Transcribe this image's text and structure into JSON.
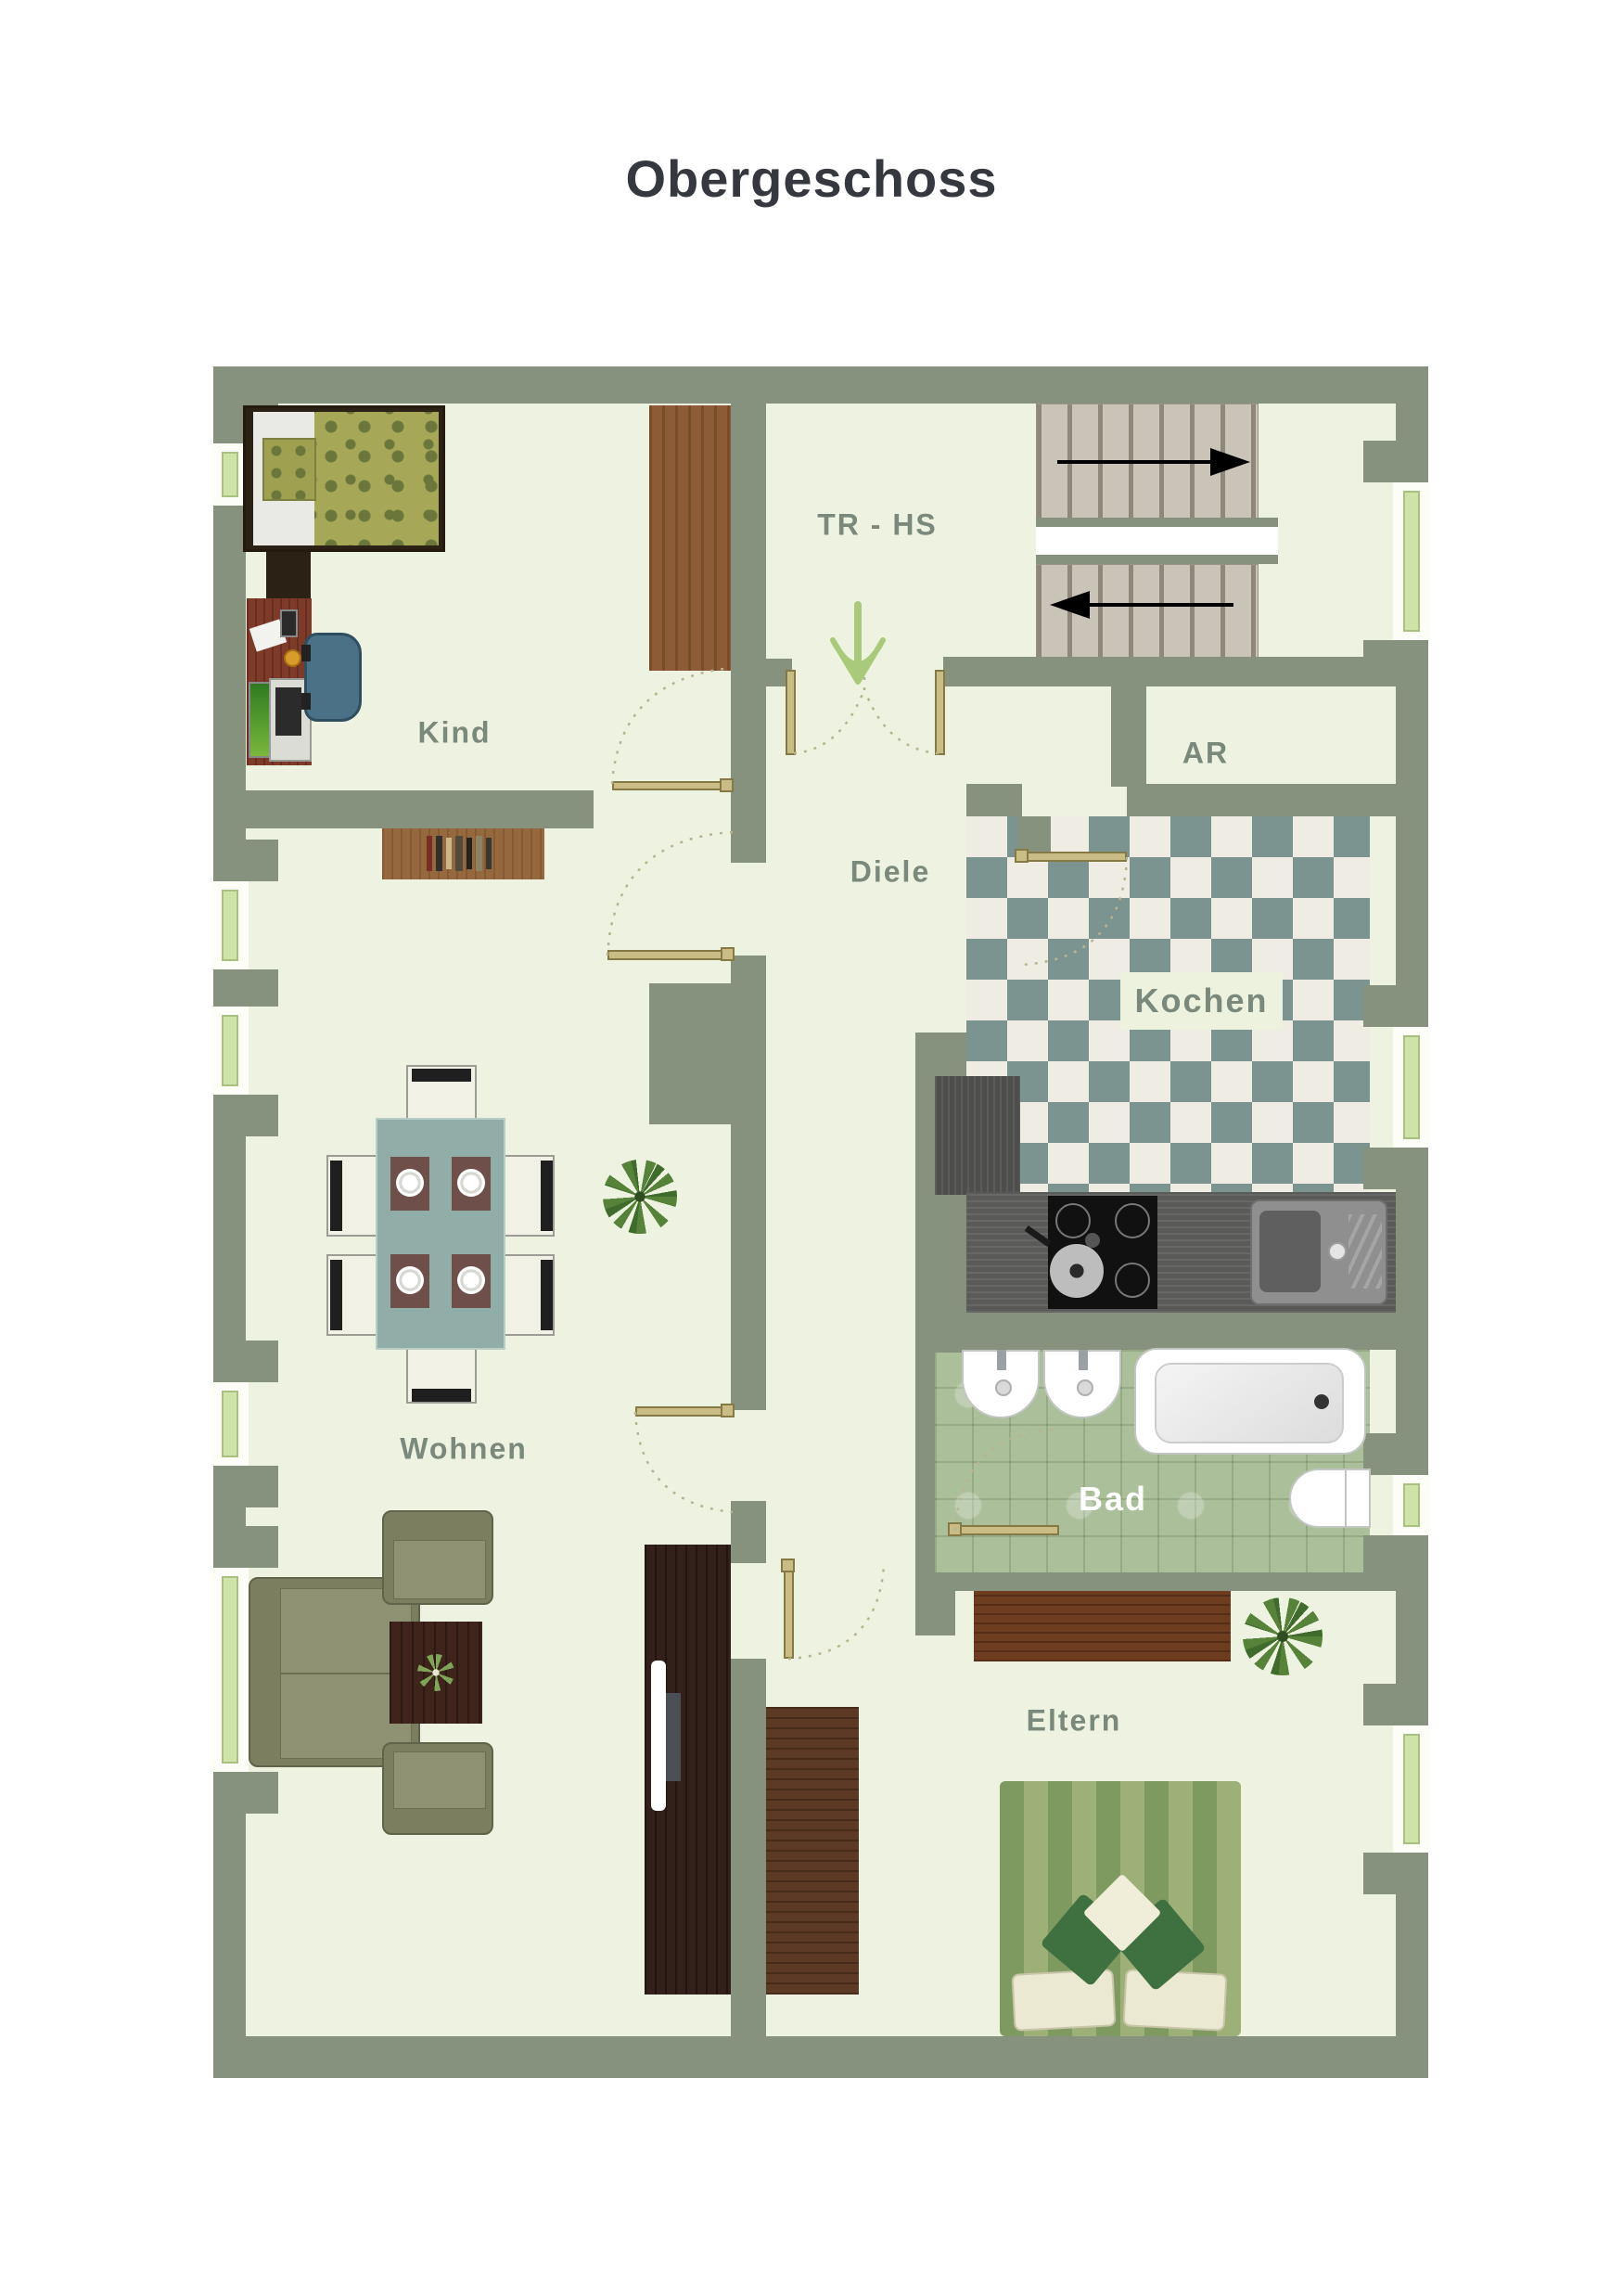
{
  "title": "Obergeschoss",
  "rooms": {
    "kind": {
      "label": "Kind"
    },
    "tr_hs": {
      "label": "TR - HS"
    },
    "ar": {
      "label": "AR"
    },
    "diele": {
      "label": "Diele"
    },
    "kochen": {
      "label": "Kochen"
    },
    "bad": {
      "label": "Bad"
    },
    "wohnen": {
      "label": "Wohnen"
    },
    "eltern": {
      "label": "Eltern"
    }
  },
  "colors": {
    "wall": "#87927e",
    "floor": "#eef3e1",
    "window_glass": "#cfe2a8",
    "door": "#c9bd85",
    "room_label_text": "#7a897b",
    "bad_label_text": "#ffffff",
    "kitchen_tile_teal": "#7b948f",
    "kitchen_tile_white": "#efece4",
    "bath_tile_green": "#abbf9a",
    "stair_arrow": "#000000",
    "entrance_arrow": "#a8ca7a",
    "title_text": "#35383e"
  },
  "annotations": {
    "stairs_upper_arrow_direction": "right",
    "stairs_lower_arrow_direction": "left",
    "entrance_arrow_direction": "down"
  }
}
